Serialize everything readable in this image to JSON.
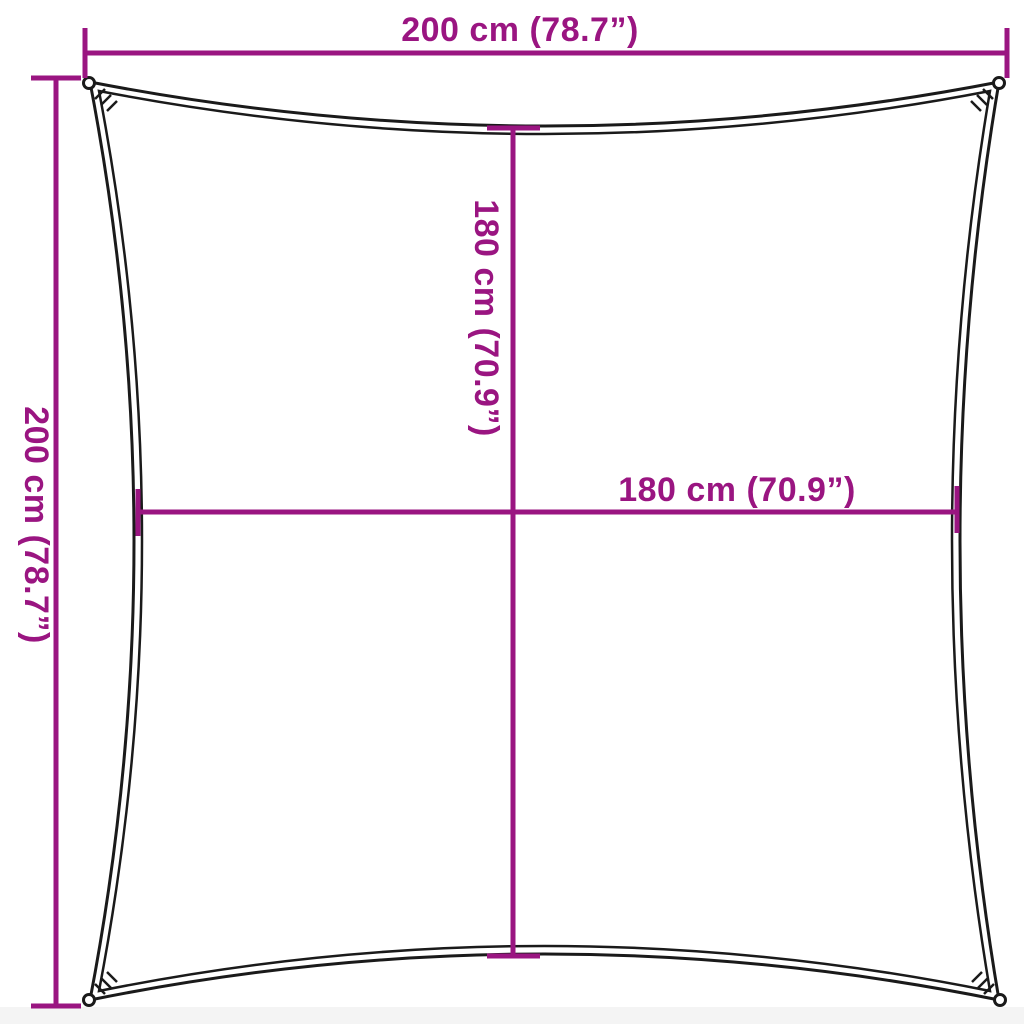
{
  "diagram": {
    "colors": {
      "dimension_accent": "#9a1581",
      "sail_outline": "#1a1a1a",
      "background": "#ffffff"
    },
    "labels": {
      "top_width": "200 cm (78.7”)",
      "left_height": "200 cm (78.7”)",
      "inner_height": "180 cm (70.9”)",
      "inner_width": "180 cm (70.9”)"
    }
  }
}
